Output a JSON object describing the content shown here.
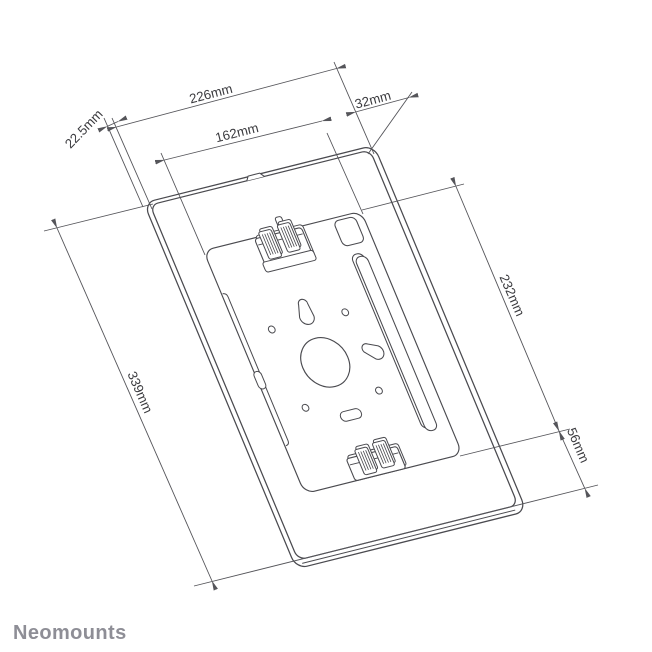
{
  "drawing": {
    "brand": "Neomounts",
    "dimensions": {
      "width_outer": "226mm",
      "width_plate": "162mm",
      "right_offset": "32mm",
      "edge_depth": "22.5mm",
      "plate_height": "232mm",
      "height_outer": "339mm",
      "bottom_offset": "56mm"
    },
    "colors": {
      "line": "#4a4a4f",
      "dimension_line": "#55555a",
      "label": "#3a3a3e",
      "brand": "#8e8e96",
      "background": "#ffffff"
    }
  }
}
